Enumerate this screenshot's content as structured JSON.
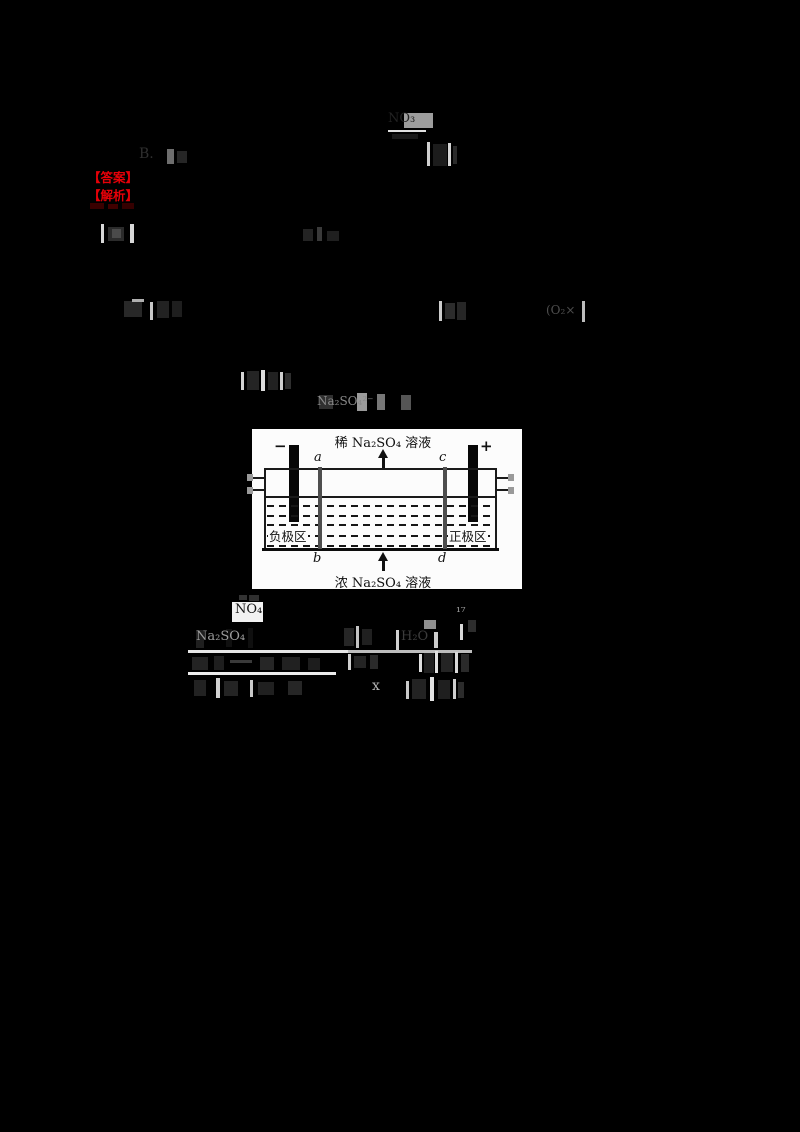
{
  "answer_block": {
    "answer_label": "【答案】",
    "analysis_label": "【解析】",
    "color": "#e60008"
  },
  "diagram": {
    "top_label": "稀 Na₂SO₄ 溶液",
    "bottom_label": "浓 Na₂SO₄ 溶液",
    "minus_sign": "−",
    "plus_sign": "+",
    "label_a": "a",
    "label_b": "b",
    "label_c": "c",
    "label_d": "d",
    "left_region": "负极区",
    "right_region": "正极区",
    "membrane_color": "#4e4e4e",
    "electrode_color": "#070707",
    "panel_bg": "#fcfcfc"
  },
  "fragments": [
    {
      "x": 388,
      "y": 112,
      "w": 46,
      "h": 30,
      "text": "NO₃",
      "color": "#222222",
      "fs": 13,
      "bars": [
        {
          "dx": 16,
          "dy": 1,
          "w": 29,
          "h": 15,
          "c": "#9d9d9d"
        },
        {
          "dx": 0,
          "dy": 18,
          "w": 38,
          "h": 2,
          "c": "#e0e0e0"
        },
        {
          "dx": 4,
          "dy": 22,
          "w": 26,
          "h": 5,
          "c": "#181818"
        }
      ]
    },
    {
      "x": 139,
      "y": 147,
      "w": 48,
      "h": 20,
      "text": "B.",
      "color": "#2f2f2f",
      "fs": 14,
      "bars": [
        {
          "dx": 28,
          "dy": 2,
          "w": 7,
          "h": 15,
          "c": "#6e6e6e"
        },
        {
          "dx": 38,
          "dy": 4,
          "w": 10,
          "h": 12,
          "c": "#262626"
        }
      ]
    },
    {
      "x": 425,
      "y": 140,
      "w": 34,
      "h": 28,
      "bars": [
        {
          "dx": 2,
          "dy": 2,
          "w": 3,
          "h": 24,
          "c": "#cfcfcf"
        },
        {
          "dx": 8,
          "dy": 4,
          "w": 14,
          "h": 22,
          "c": "#1c1c1c"
        },
        {
          "dx": 23,
          "dy": 3,
          "w": 3,
          "h": 23,
          "c": "#d6d6d6"
        },
        {
          "dx": 28,
          "dy": 6,
          "w": 4,
          "h": 18,
          "c": "#2a2a2a"
        }
      ]
    },
    {
      "x": 100,
      "y": 224,
      "w": 38,
      "h": 20,
      "bars": [
        {
          "dx": 1,
          "dy": 0,
          "w": 3,
          "h": 19,
          "c": "#d8d8d8"
        },
        {
          "dx": 8,
          "dy": 3,
          "w": 16,
          "h": 14,
          "c": "#2b2b2b"
        },
        {
          "dx": 12,
          "dy": 5,
          "w": 9,
          "h": 9,
          "c": "#4a4a4a"
        },
        {
          "dx": 30,
          "dy": 0,
          "w": 4,
          "h": 19,
          "c": "#d8d8d8"
        }
      ]
    },
    {
      "x": 303,
      "y": 227,
      "w": 40,
      "h": 17,
      "bars": [
        {
          "dx": 0,
          "dy": 2,
          "w": 10,
          "h": 12,
          "c": "#242424"
        },
        {
          "dx": 14,
          "dy": 0,
          "w": 5,
          "h": 14,
          "c": "#3a3a3a"
        },
        {
          "dx": 24,
          "dy": 4,
          "w": 12,
          "h": 10,
          "c": "#1f1f1f"
        }
      ]
    },
    {
      "x": 124,
      "y": 299,
      "w": 60,
      "h": 23,
      "bars": [
        {
          "dx": 0,
          "dy": 2,
          "w": 18,
          "h": 16,
          "c": "#282828"
        },
        {
          "dx": 8,
          "dy": 0,
          "w": 12,
          "h": 3,
          "c": "#b0b0b0"
        },
        {
          "dx": 26,
          "dy": 3,
          "w": 3,
          "h": 18,
          "c": "#c8c8c8"
        },
        {
          "dx": 33,
          "dy": 2,
          "w": 12,
          "h": 17,
          "c": "#222222"
        },
        {
          "dx": 48,
          "dy": 2,
          "w": 10,
          "h": 16,
          "c": "#1e1e1e"
        }
      ]
    },
    {
      "x": 439,
      "y": 301,
      "w": 30,
      "h": 22,
      "bars": [
        {
          "dx": 0,
          "dy": 0,
          "w": 3,
          "h": 20,
          "c": "#cccccc"
        },
        {
          "dx": 6,
          "dy": 2,
          "w": 10,
          "h": 16,
          "c": "#2c2c2c"
        },
        {
          "dx": 18,
          "dy": 1,
          "w": 9,
          "h": 18,
          "c": "#262626"
        }
      ]
    },
    {
      "x": 546,
      "y": 301,
      "w": 42,
      "h": 23,
      "text": "(O₂×",
      "color": "#4e4e4e",
      "fs": 12,
      "ty": 3,
      "bars": [
        {
          "dx": 36,
          "dy": 0,
          "w": 3,
          "h": 21,
          "c": "#bdbdbd"
        }
      ]
    },
    {
      "x": 239,
      "y": 370,
      "w": 54,
      "h": 22,
      "bars": [
        {
          "dx": 2,
          "dy": 2,
          "w": 3,
          "h": 18,
          "c": "#d5d5d5"
        },
        {
          "dx": 8,
          "dy": 1,
          "w": 12,
          "h": 19,
          "c": "#242424"
        },
        {
          "dx": 22,
          "dy": 0,
          "w": 4,
          "h": 21,
          "c": "#dddddd"
        },
        {
          "dx": 29,
          "dy": 2,
          "w": 10,
          "h": 18,
          "c": "#212121"
        },
        {
          "dx": 41,
          "dy": 2,
          "w": 3,
          "h": 18,
          "c": "#cfcfcf"
        },
        {
          "dx": 46,
          "dy": 3,
          "w": 6,
          "h": 16,
          "c": "#2e2e2e"
        }
      ]
    },
    {
      "x": 317,
      "y": 393,
      "w": 96,
      "h": 20,
      "text": "Na₂SO₄²⁻",
      "color": "#8a8a8a",
      "fs": 12,
      "ty": 2,
      "bars": [
        {
          "dx": 2,
          "dy": 2,
          "w": 14,
          "h": 14,
          "c": "#303030"
        },
        {
          "dx": 40,
          "dy": 0,
          "w": 10,
          "h": 18,
          "c": "#9a9a9a"
        },
        {
          "dx": 60,
          "dy": 1,
          "w": 8,
          "h": 16,
          "c": "#777777"
        },
        {
          "dx": 84,
          "dy": 2,
          "w": 10,
          "h": 15,
          "c": "#555555"
        }
      ]
    },
    {
      "x": 231,
      "y": 595,
      "w": 36,
      "h": 28,
      "text": "NO₄",
      "color": "#161616",
      "fs": 13,
      "tx": 4,
      "ty": 8,
      "bars": [
        {
          "dx": 1,
          "dy": 7,
          "w": 31,
          "h": 20,
          "c": "#f2f2f2"
        },
        {
          "dx": 8,
          "dy": 0,
          "w": 8,
          "h": 5,
          "c": "#333333"
        },
        {
          "dx": 18,
          "dy": 0,
          "w": 10,
          "h": 6,
          "c": "#2f2f2f"
        }
      ]
    },
    {
      "x": 196,
      "y": 628,
      "w": 72,
      "h": 22,
      "text": "Na₂SO₄",
      "color": "#9b9b9b",
      "fs": 13,
      "ty": 2,
      "bars": [
        {
          "dx": 0,
          "dy": 2,
          "w": 8,
          "h": 18,
          "c": "#1f1f1f"
        },
        {
          "dx": 30,
          "dy": 1,
          "w": 6,
          "h": 18,
          "c": "#101010"
        },
        {
          "dx": 52,
          "dy": 0,
          "w": 5,
          "h": 20,
          "c": "#0f0f0f"
        }
      ]
    },
    {
      "x": 344,
      "y": 624,
      "w": 30,
      "h": 26,
      "bars": [
        {
          "dx": 0,
          "dy": 4,
          "w": 10,
          "h": 18,
          "c": "#262626"
        },
        {
          "dx": 12,
          "dy": 2,
          "w": 3,
          "h": 22,
          "c": "#c4c4c4"
        },
        {
          "dx": 18,
          "dy": 5,
          "w": 10,
          "h": 16,
          "c": "#202020"
        }
      ]
    },
    {
      "x": 394,
      "y": 620,
      "w": 46,
      "h": 32,
      "text": "H₂O",
      "color": "#3c3c3c",
      "fs": 13,
      "tx": 7,
      "ty": 10,
      "bars": [
        {
          "dx": 2,
          "dy": 10,
          "w": 3,
          "h": 20,
          "c": "#d0d0d0"
        },
        {
          "dx": 30,
          "dy": 0,
          "w": 12,
          "h": 9,
          "c": "#8f8f8f"
        },
        {
          "dx": 40,
          "dy": 12,
          "w": 4,
          "h": 16,
          "c": "#cccccc"
        }
      ]
    },
    {
      "x": 456,
      "y": 606,
      "w": 26,
      "h": 36,
      "text": "¹⁷",
      "color": "#9f9f9f",
      "fs": 12,
      "bars": [
        {
          "dx": 4,
          "dy": 18,
          "w": 3,
          "h": 16,
          "c": "#d9d9d9"
        },
        {
          "dx": 12,
          "dy": 14,
          "w": 8,
          "h": 12,
          "c": "#2d2d2d"
        }
      ]
    },
    {
      "x": 188,
      "y": 650,
      "w": 284,
      "h": 4,
      "bars": [
        {
          "dx": 0,
          "dy": 0,
          "w": 284,
          "h": 3,
          "c": "#e6e6e6"
        },
        {
          "dx": 160,
          "dy": 0,
          "w": 124,
          "h": 3,
          "c": "#bdbdbd"
        }
      ]
    },
    {
      "x": 190,
      "y": 655,
      "w": 150,
      "h": 17,
      "bars": [
        {
          "dx": 2,
          "dy": 2,
          "w": 16,
          "h": 13,
          "c": "#232323"
        },
        {
          "dx": 24,
          "dy": 1,
          "w": 10,
          "h": 14,
          "c": "#1e1e1e"
        },
        {
          "dx": 40,
          "dy": 5,
          "w": 22,
          "h": 3,
          "c": "#3a3a3a"
        },
        {
          "dx": 70,
          "dy": 2,
          "w": 14,
          "h": 13,
          "c": "#262626"
        },
        {
          "dx": 92,
          "dy": 2,
          "w": 18,
          "h": 13,
          "c": "#212121"
        },
        {
          "dx": 118,
          "dy": 3,
          "w": 12,
          "h": 12,
          "c": "#1d1d1d"
        }
      ]
    },
    {
      "x": 348,
      "y": 653,
      "w": 34,
      "h": 18,
      "bars": [
        {
          "dx": 0,
          "dy": 1,
          "w": 3,
          "h": 16,
          "c": "#cfcfcf"
        },
        {
          "dx": 6,
          "dy": 3,
          "w": 12,
          "h": 12,
          "c": "#242424"
        },
        {
          "dx": 22,
          "dy": 2,
          "w": 8,
          "h": 14,
          "c": "#2a2a2a"
        }
      ]
    },
    {
      "x": 419,
      "y": 651,
      "w": 52,
      "h": 24,
      "bars": [
        {
          "dx": 0,
          "dy": 3,
          "w": 3,
          "h": 18,
          "c": "#dedede"
        },
        {
          "dx": 5,
          "dy": 2,
          "w": 10,
          "h": 20,
          "c": "#1f1f1f"
        },
        {
          "dx": 16,
          "dy": 0,
          "w": 3,
          "h": 22,
          "c": "#e0e0e0"
        },
        {
          "dx": 22,
          "dy": 2,
          "w": 12,
          "h": 19,
          "c": "#242424"
        },
        {
          "dx": 36,
          "dy": 1,
          "w": 3,
          "h": 21,
          "c": "#d8d8d8"
        },
        {
          "dx": 42,
          "dy": 3,
          "w": 8,
          "h": 18,
          "c": "#2a2a2a"
        }
      ]
    },
    {
      "x": 188,
      "y": 672,
      "w": 148,
      "h": 4,
      "bars": [
        {
          "dx": 0,
          "dy": 0,
          "w": 148,
          "h": 3,
          "c": "#ececec"
        }
      ]
    },
    {
      "x": 194,
      "y": 678,
      "w": 122,
      "h": 22,
      "bars": [
        {
          "dx": 0,
          "dy": 2,
          "w": 12,
          "h": 16,
          "c": "#222222"
        },
        {
          "dx": 22,
          "dy": 0,
          "w": 4,
          "h": 20,
          "c": "#d2d2d2"
        },
        {
          "dx": 30,
          "dy": 3,
          "w": 14,
          "h": 15,
          "c": "#242424"
        },
        {
          "dx": 56,
          "dy": 2,
          "w": 3,
          "h": 17,
          "c": "#c9c9c9"
        },
        {
          "dx": 64,
          "dy": 4,
          "w": 16,
          "h": 13,
          "c": "#202020"
        },
        {
          "dx": 94,
          "dy": 3,
          "w": 14,
          "h": 14,
          "c": "#262626"
        }
      ]
    },
    {
      "x": 372,
      "y": 679,
      "w": 22,
      "h": 18,
      "text": "x",
      "color": "#b5b5b5",
      "fs": 14
    },
    {
      "x": 406,
      "y": 677,
      "w": 58,
      "h": 26,
      "bars": [
        {
          "dx": 0,
          "dy": 4,
          "w": 3,
          "h": 18,
          "c": "#c9c9c9"
        },
        {
          "dx": 6,
          "dy": 2,
          "w": 14,
          "h": 20,
          "c": "#232323"
        },
        {
          "dx": 24,
          "dy": 0,
          "w": 4,
          "h": 24,
          "c": "#e3e3e3"
        },
        {
          "dx": 32,
          "dy": 3,
          "w": 12,
          "h": 19,
          "c": "#1f1f1f"
        },
        {
          "dx": 47,
          "dy": 2,
          "w": 3,
          "h": 20,
          "c": "#cfcfcf"
        },
        {
          "dx": 52,
          "dy": 5,
          "w": 6,
          "h": 16,
          "c": "#2b2b2b"
        }
      ]
    },
    {
      "x": 90,
      "y": 203,
      "w": 44,
      "h": 7,
      "bars": [
        {
          "dx": 0,
          "dy": 0,
          "w": 14,
          "h": 6,
          "c": "#3a0000"
        },
        {
          "dx": 18,
          "dy": 1,
          "w": 10,
          "h": 5,
          "c": "#400000"
        },
        {
          "dx": 32,
          "dy": 0,
          "w": 12,
          "h": 6,
          "c": "#350000"
        }
      ]
    }
  ]
}
